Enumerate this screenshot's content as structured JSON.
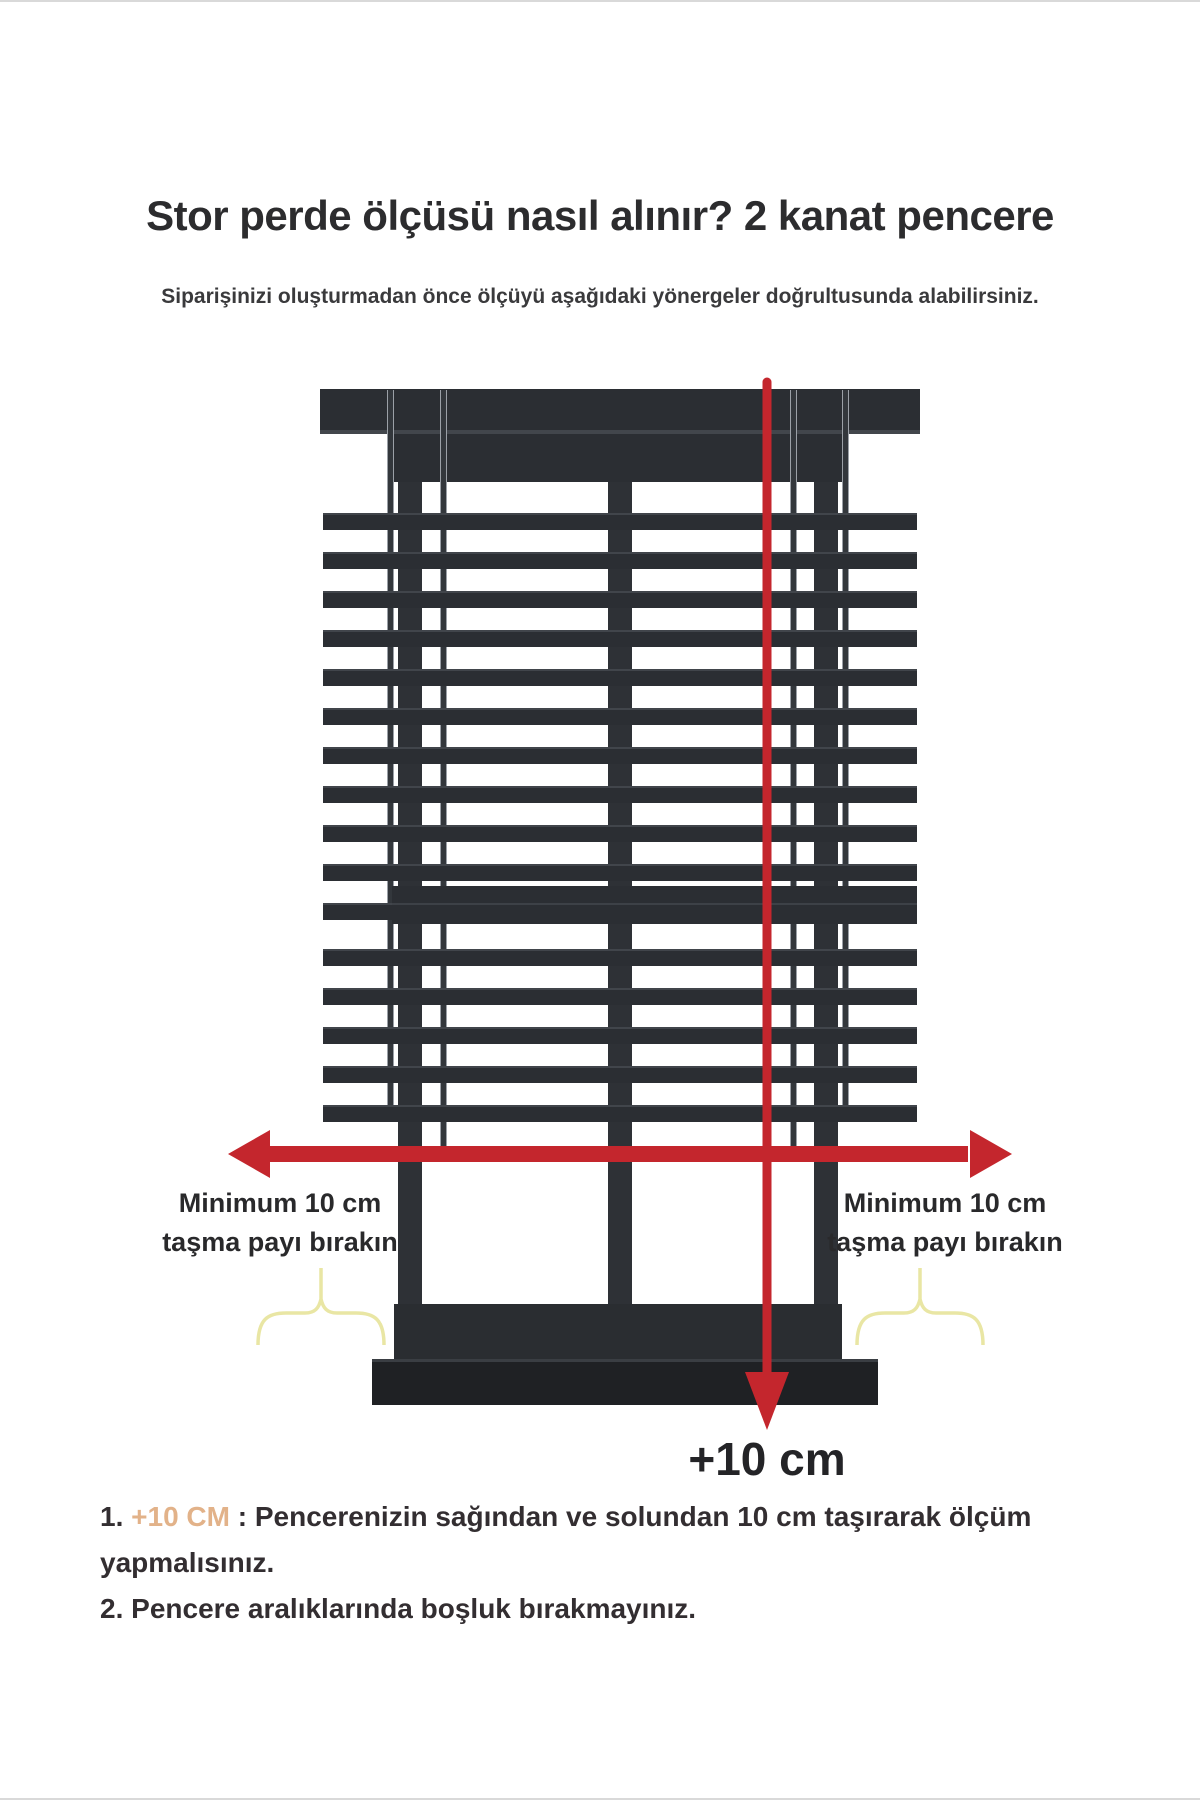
{
  "title": "Stor perde ölçüsü nasıl alınır? 2 kanat pencere",
  "subtitle": "Siparişinizi oluşturmadan önce ölçüyü aşağıdaki yönergeler doğrultusunda alabilirsiniz.",
  "diagram": {
    "left_overhang_label": {
      "line1": "Minimum 10 cm",
      "line2": "taşma payı bırakın"
    },
    "right_overhang_label": {
      "line1": "Minimum 10 cm",
      "line2": "taşma payı bırakın"
    },
    "bottom_measure_label": "+10 cm",
    "colors": {
      "arrow_red": "#c4262d",
      "blind_dark": "#2b2e33",
      "frame_dark": "#2e3136",
      "sill_dark": "#1f2124",
      "brace_yellow": "#e9e6a4",
      "highlight_tan": "#e2b289"
    }
  },
  "instructions": [
    {
      "prefix": "1. ",
      "highlight": "+10 CM",
      "suffix": " : Pencerenizin sağından ve solundan 10 cm taşırarak ölçüm yapmalısınız."
    },
    {
      "prefix": "2. ",
      "highlight": "",
      "suffix": "Pencere aralıklarında boşluk bırakmayınız."
    }
  ]
}
